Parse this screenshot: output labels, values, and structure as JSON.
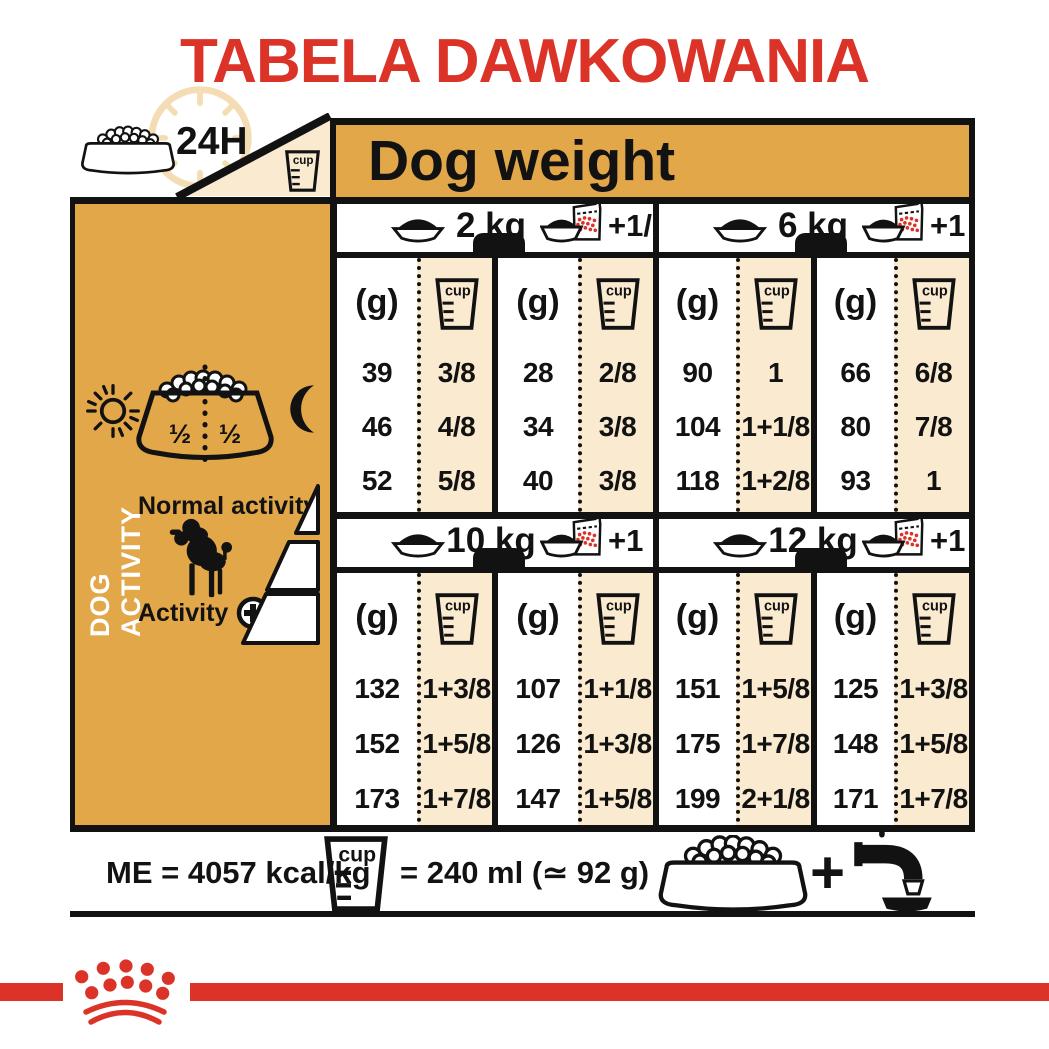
{
  "title": "TABELA DAWKOWANIA",
  "colors": {
    "orange": "#E2A748",
    "cream": "#FAEAD0",
    "red": "#DB3327",
    "ink": "#121212",
    "clock": "#F4DDB5"
  },
  "header": {
    "duration": "24H",
    "dog_weight": "Dog weight"
  },
  "labels": {
    "g": "(g)",
    "cup": "cup"
  },
  "sidebar": {
    "dog_activity": "DOG ACTIVITY",
    "half_left": "½",
    "half_right": "½",
    "normal_activity": "Normal activity",
    "activity": "Activity"
  },
  "sections": [
    {
      "weight": "2 kg",
      "wet_add": "+1/2",
      "dry": [
        {
          "g": "39",
          "cup": "3/8"
        },
        {
          "g": "46",
          "cup": "4/8"
        },
        {
          "g": "52",
          "cup": "5/8"
        }
      ],
      "wet": [
        {
          "g": "28",
          "cup": "2/8"
        },
        {
          "g": "34",
          "cup": "3/8"
        },
        {
          "g": "40",
          "cup": "3/8"
        }
      ]
    },
    {
      "weight": "6 kg",
      "wet_add": "+1",
      "dry": [
        {
          "g": "90",
          "cup": "1"
        },
        {
          "g": "104",
          "cup": "1+1/8"
        },
        {
          "g": "118",
          "cup": "1+2/8"
        }
      ],
      "wet": [
        {
          "g": "66",
          "cup": "6/8"
        },
        {
          "g": "80",
          "cup": "7/8"
        },
        {
          "g": "93",
          "cup": "1"
        }
      ]
    },
    {
      "weight": "10 kg",
      "wet_add": "+1",
      "dry": [
        {
          "g": "132",
          "cup": "1+3/8"
        },
        {
          "g": "152",
          "cup": "1+5/8"
        },
        {
          "g": "173",
          "cup": "1+7/8"
        }
      ],
      "wet": [
        {
          "g": "107",
          "cup": "1+1/8"
        },
        {
          "g": "126",
          "cup": "1+3/8"
        },
        {
          "g": "147",
          "cup": "1+5/8"
        }
      ]
    },
    {
      "weight": "12 kg",
      "wet_add": "+1",
      "dry": [
        {
          "g": "151",
          "cup": "1+5/8"
        },
        {
          "g": "175",
          "cup": "1+7/8"
        },
        {
          "g": "199",
          "cup": "2+1/8"
        }
      ],
      "wet": [
        {
          "g": "125",
          "cup": "1+3/8"
        },
        {
          "g": "148",
          "cup": "1+5/8"
        },
        {
          "g": "171",
          "cup": "1+7/8"
        }
      ]
    }
  ],
  "footer": {
    "me": "ME = 4057 kcal/kg",
    "cup_equals": "= 240 ml (≃ 92 g)",
    "plus": "+"
  }
}
